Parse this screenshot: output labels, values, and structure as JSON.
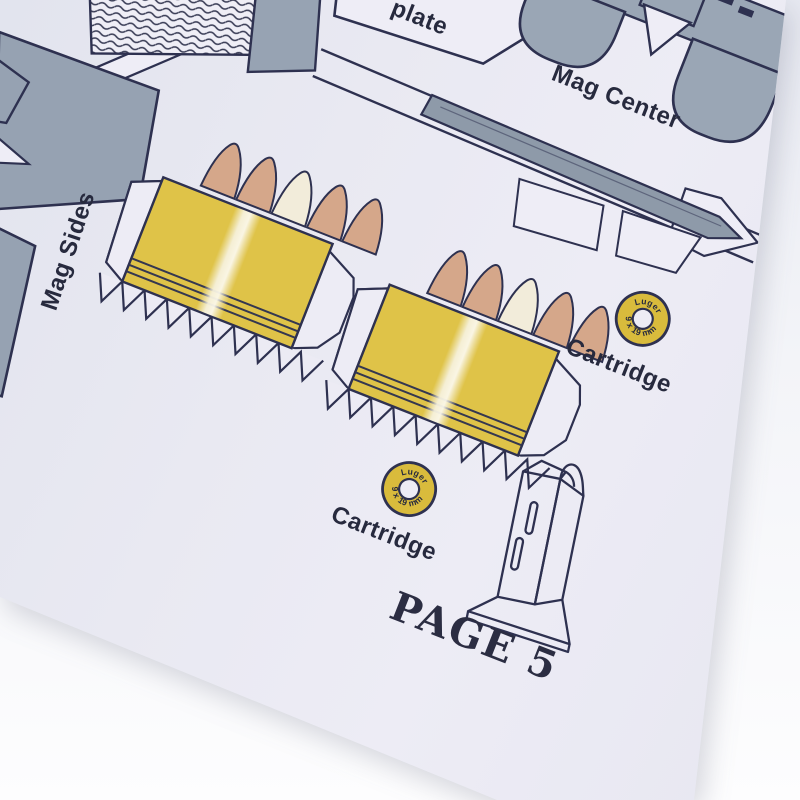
{
  "photo": {
    "description": "papercraft template sheet photographed at an angle",
    "page_number_label": "PAGE 5",
    "parts": {
      "plate_label": "plate",
      "mag_center_label": "Mag Center",
      "mag_sides_label": "Mag Sides",
      "cartridge_label_right": "Cartridge",
      "cartridge_label_lower": "Cartridge",
      "cartridge_caliber_top": "Luger",
      "cartridge_caliber_bottom": "9 x 19 mm"
    },
    "colors": {
      "paper": "#eaeaf3",
      "backdrop": "#fbfbfd",
      "ink_navy": "#2e3150",
      "part_gray": "#97a3b3",
      "brass_yellow": "#dfc348",
      "bullet_tan": "#d5a78a",
      "ring_gold": "#d9bb3c",
      "highlight_cream": "#f2ecda"
    }
  }
}
